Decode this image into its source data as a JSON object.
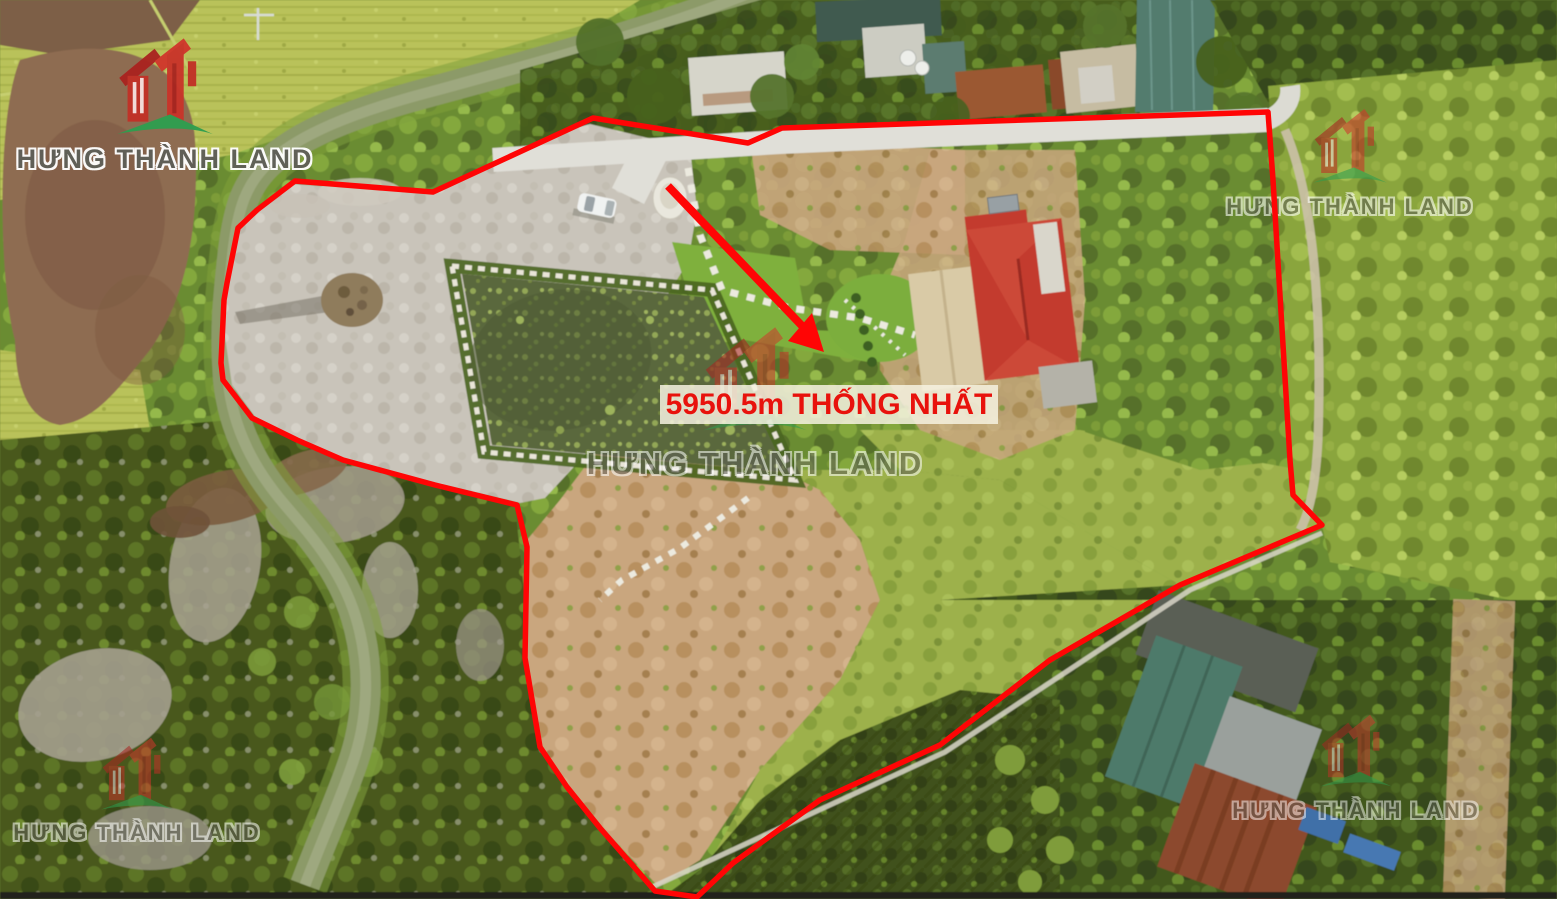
{
  "label": {
    "text": "5950.5m THỐNG NHẤT"
  },
  "watermark": {
    "text": "HƯNG THÀNH LAND",
    "monogram": "HT",
    "positions": [
      "top-left",
      "top-right",
      "center",
      "bottom-left",
      "bottom-right"
    ]
  },
  "colors": {
    "boundary": "#ff0505",
    "arrow": "#ff0505",
    "label_text": "#e8120c",
    "label_background": "#f6f2e0",
    "logo_red": "#c0362a",
    "logo_green": "#2f9e4f",
    "watermark_text": "#5f5f58"
  }
}
